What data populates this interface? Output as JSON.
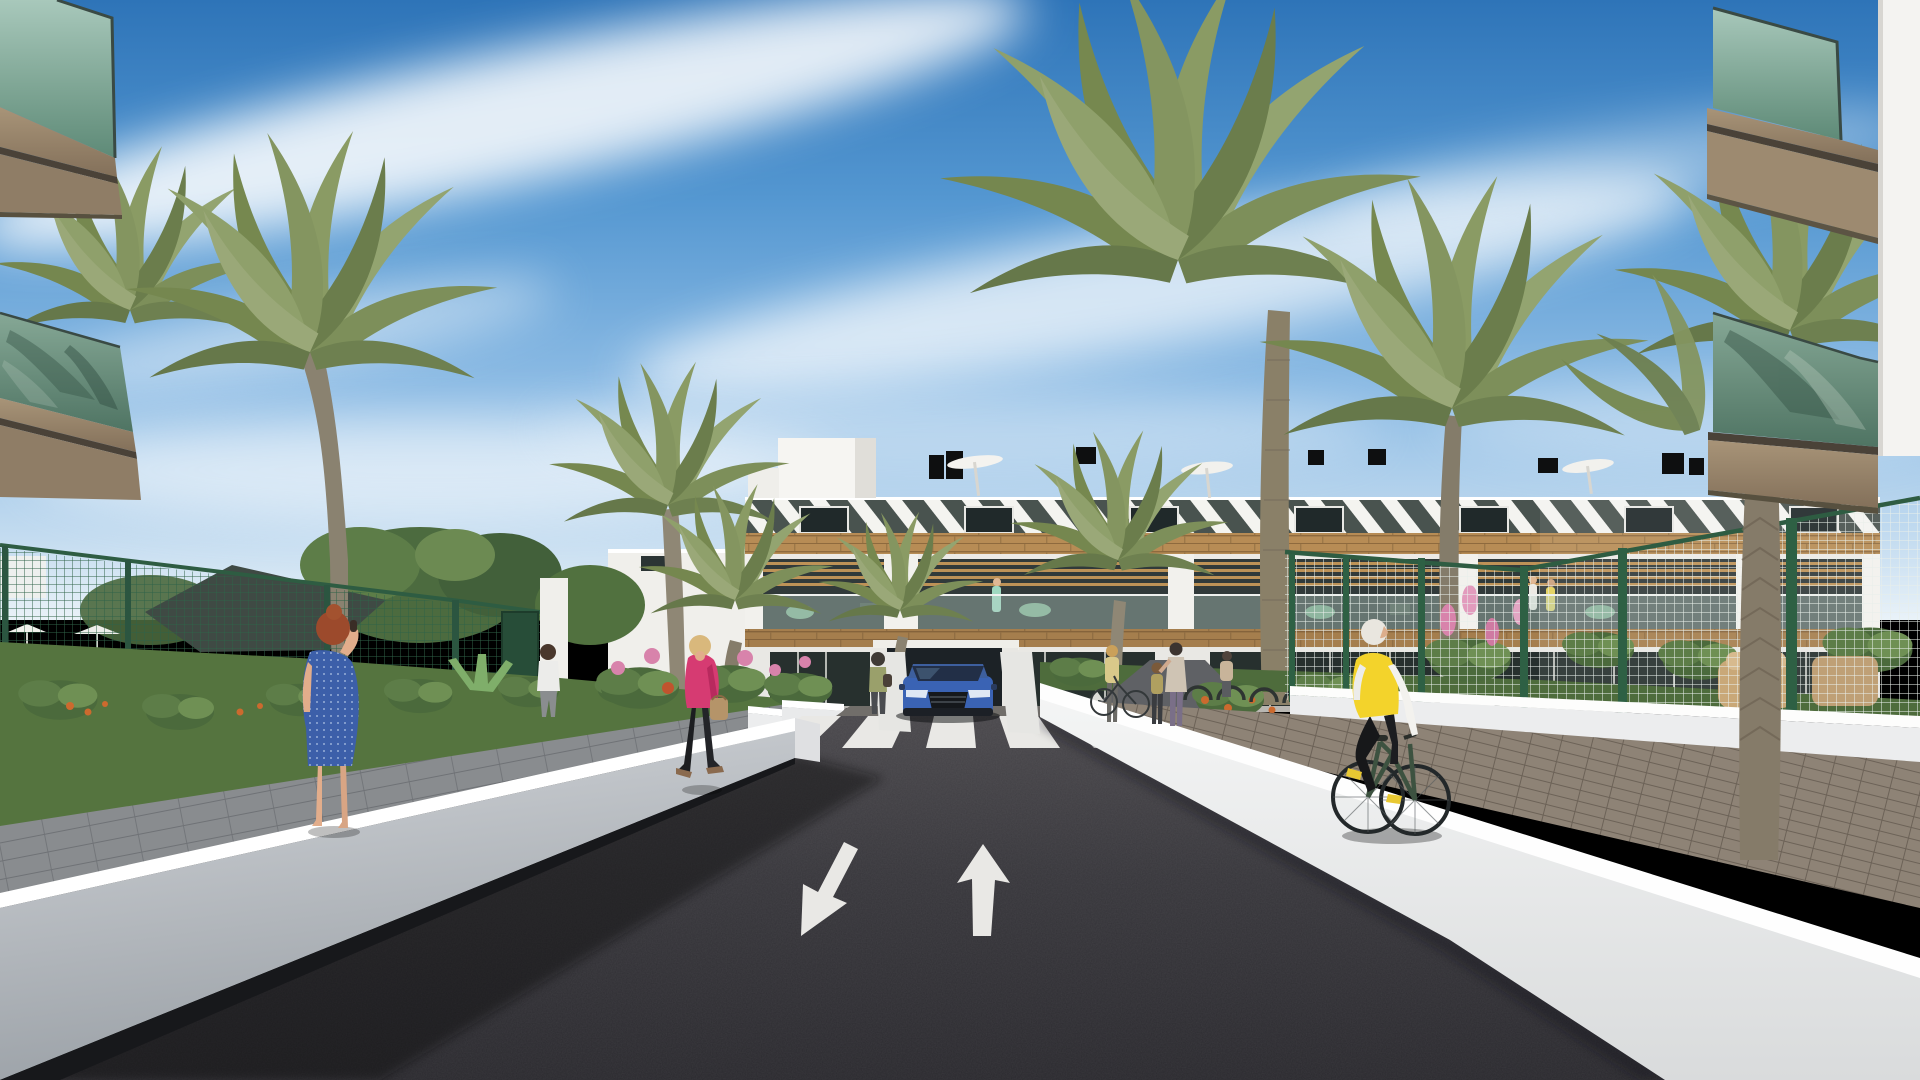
{
  "meta": {
    "title": "Residential development exterior 3D render",
    "type": "architectural-visualization",
    "dimensions": "1920x1080"
  },
  "palette": {
    "sky_top": "#2e74b8",
    "sky_mid": "#6ea6d9",
    "sky_horizon": "#e9f2f8",
    "asphalt": "#35343a",
    "asphalt_light": "#4a484c",
    "road_marking": "#e9e8e5",
    "wall_white": "#eef0f1",
    "wall_gray": "#c2c6cb",
    "planter_white": "#ecedee",
    "facade_white": "#f2f1ed",
    "wood": "#b78c55",
    "fascia_tan": "#9d8a70",
    "glass_teal": "#8fb6a8",
    "glass_dark": "#27302e",
    "fence_green": "#2f6246",
    "palm_green": "#84955f",
    "garden_green": "#55743f",
    "flower_pink": "#d883ab",
    "flower_orange": "#cc6a2e",
    "brick_path": "#8e8376",
    "paver_gray": "#898c8f",
    "car_blue": "#3a63b4",
    "jacket_pink": "#d63b72",
    "dress_blue": "#3c5fa9",
    "vest_yellow": "#f3d32b",
    "hair_auburn": "#9c4a2c",
    "skin": "#e2ad8b"
  },
  "objects": {
    "building": "three-storey white apartment block with wood cladding band, louvered sun screens and pergola balconies",
    "road": "dark asphalt entry drive with zebra crossing and two painted lane arrows",
    "arrows": [
      "down-left arrow",
      "up arrow"
    ],
    "vehicle": "blue SUV emerging from underground garage ramp",
    "people": [
      "woman in blue dotted dress talking on phone",
      "woman in pink jacket carrying handbag",
      "man in white t-shirt walking to entrance",
      "woman standing near garage ramp",
      "cyclist in yellow vest on brick path",
      "pedestrian group near bike racks",
      "residents on balcony"
    ],
    "vegetation": [
      "date palms",
      "leafy trees",
      "flower beds",
      "shade sail garden"
    ],
    "foreground": [
      "glass balconies top-left",
      "glass balconies top-right"
    ]
  }
}
